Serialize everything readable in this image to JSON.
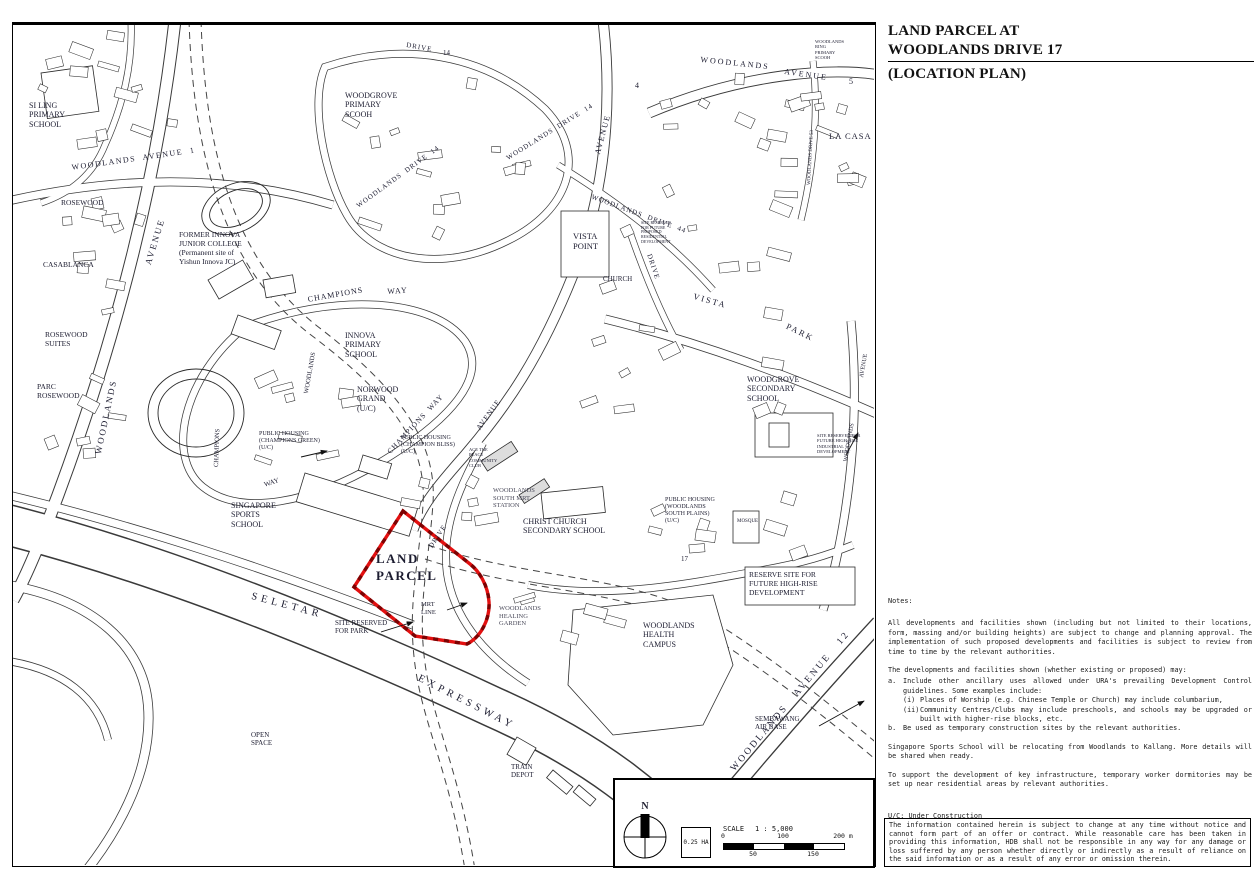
{
  "title": {
    "line1": "LAND PARCEL AT",
    "line2": "WOODLANDS DRIVE 17",
    "line3": "(LOCATION PLAN)"
  },
  "notes": {
    "heading": "Notes:",
    "para1": "All developments and facilities shown (including but not limited to their locations, form, massing and/or building heights) are subject to change and planning approval. The implementation of such proposed developments and facilities is subject to review from time to time by the relevant authorities.",
    "para2_intro": "The developments and facilities shown (whether existing or proposed) may:",
    "item_a_marker": "a.",
    "item_a": "Include other ancillary uses allowed under URA's prevailing Development Control guidelines. Some examples include:",
    "item_ai_marker": "(i)",
    "item_ai": "Places of Worship (e.g. Chinese Temple or Church) may include columbarium,",
    "item_aii_marker": "(ii)",
    "item_aii": "Community Centres/Clubs may include preschools, and schools may be upgraded or built with higher-rise blocks, etc.",
    "item_b_marker": "b.",
    "item_b": "Be used as temporary construction sites by the relevant authorities.",
    "para3": "Singapore Sports School will be relocating from Woodlands to Kallang. More details will be shared when ready.",
    "para4": "To support the development of key infrastructure,  temporary worker dormitories may be set up near residential areas by relevant authorities.",
    "uc": "U/C: Under Construction"
  },
  "disclaimer": "The information contained herein is subject to change at any time without notice and cannot form part of an offer or contract. While reasonable care has been taken in providing this information, HDB shall not be responsible in any way for any damage or loss suffered by any person whether directly or indirectly as a result of reliance on the said information or as a result of any error or omission therein.",
  "map": {
    "parcel_color": "#e31010",
    "parcel_dash_color": "#7d0202",
    "scale": {
      "north": "N",
      "area": "0.25 HA",
      "scale_label": "SCALE",
      "ratio": "1 : 5,000",
      "ticks_top": [
        "0",
        "100",
        "200 m"
      ],
      "ticks_bottom": [
        "50",
        "150"
      ]
    },
    "labels": [
      {
        "text": "SI LING\nPRIMARY\nSCHOOL",
        "x": 16,
        "y": 76,
        "size": 8
      },
      {
        "text": "WOODLANDS  AVENUE  1",
        "x": 58,
        "y": 138,
        "rot": -8,
        "size": 8,
        "ls": 1.5
      },
      {
        "text": "ROSEWOOD",
        "x": 48,
        "y": 174,
        "size": 7.5
      },
      {
        "text": "CASABLANCA",
        "x": 30,
        "y": 236,
        "size": 7.5
      },
      {
        "text": "ROSEWOOD\nSUITES",
        "x": 32,
        "y": 306,
        "size": 7.5
      },
      {
        "text": "PARC\nROSEWOOD",
        "x": 24,
        "y": 358,
        "size": 7.5
      },
      {
        "text": "WOODLANDS",
        "x": 80,
        "y": 428,
        "rot": -78,
        "size": 9,
        "ls": 2
      },
      {
        "text": "AVENUE",
        "x": 130,
        "y": 238,
        "rot": -73,
        "size": 9,
        "ls": 2
      },
      {
        "text": "FORMER INNOVA\nJUNIOR COLLEGE\n(Permanent site of\nYishun Innova JC)",
        "x": 166,
        "y": 206,
        "size": 7.5
      },
      {
        "text": "WOODGROVE\nPRIMARY\nSCOOH",
        "x": 332,
        "y": 66,
        "size": 8
      },
      {
        "text": "DRIVE",
        "x": 394,
        "y": 16,
        "rot": 10,
        "size": 7,
        "ls": 1
      },
      {
        "text": "14",
        "x": 430,
        "y": 24,
        "size": 7
      },
      {
        "text": "WOODLANDS  DRIVE  14",
        "x": 342,
        "y": 178,
        "rot": -36,
        "size": 7,
        "ls": 1
      },
      {
        "text": "WOODLANDS  DRIVE  14",
        "x": 492,
        "y": 130,
        "rot": -32,
        "size": 7,
        "ls": 1
      },
      {
        "text": "WOODLANDS",
        "x": 688,
        "y": 30,
        "rot": 6,
        "size": 8,
        "ls": 2
      },
      {
        "text": "AVENUE",
        "x": 772,
        "y": 42,
        "rot": 8,
        "size": 8,
        "ls": 2
      },
      {
        "text": "5",
        "x": 836,
        "y": 52,
        "size": 8
      },
      {
        "text": "WOODLANDS\nRING\nPRIMARY\nSCOOH",
        "x": 802,
        "y": 14,
        "size": 4.5
      },
      {
        "text": "WOODLANDS DRIVE 53",
        "x": 794,
        "y": 160,
        "rot": -87,
        "size": 5
      },
      {
        "text": "LA CASA",
        "x": 816,
        "y": 106,
        "size": 8.5,
        "ls": 1
      },
      {
        "text": "AVENUE",
        "x": 580,
        "y": 128,
        "rot": -75,
        "size": 8,
        "ls": 1.5
      },
      {
        "text": "4",
        "x": 622,
        "y": 56,
        "size": 8
      },
      {
        "text": "WOODLANDS  DRIVE  44",
        "x": 580,
        "y": 168,
        "rot": 20,
        "size": 7,
        "ls": 1
      },
      {
        "text": "VISTA\nPOINT",
        "x": 560,
        "y": 206,
        "size": 8.5
      },
      {
        "text": "SITE RESERVED\nFOR FUTURE\nPROPOSED\nRESIDENTIAL\nDEVELOPMENT",
        "x": 628,
        "y": 196,
        "size": 4
      },
      {
        "text": "CHURCH",
        "x": 590,
        "y": 250,
        "size": 7
      },
      {
        "text": "DRIVE",
        "x": 640,
        "y": 228,
        "rot": 72,
        "size": 7,
        "ls": 1
      },
      {
        "text": "VISTA",
        "x": 682,
        "y": 266,
        "rot": 16,
        "size": 8.5,
        "ls": 2
      },
      {
        "text": "PARK",
        "x": 776,
        "y": 296,
        "rot": 26,
        "size": 8.5,
        "ls": 2
      },
      {
        "text": "WOODGROVE\nSECONDARY\nSCHOOL",
        "x": 734,
        "y": 350,
        "size": 8
      },
      {
        "text": "AVENUE",
        "x": 846,
        "y": 352,
        "rot": -80,
        "size": 6
      },
      {
        "text": "WOODLANDS",
        "x": 830,
        "y": 436,
        "rot": -80,
        "size": 6
      },
      {
        "text": "SITE RESERVED FOR\nFUTURE HIGH-RISE\nINDUSTRIAL\nDEVELOPMENT",
        "x": 804,
        "y": 408,
        "size": 4.5
      },
      {
        "text": "CHAMPIONS",
        "x": 294,
        "y": 270,
        "rot": -10,
        "size": 8,
        "ls": 1
      },
      {
        "text": "WAY",
        "x": 374,
        "y": 262,
        "rot": -4,
        "size": 8,
        "ls": 1
      },
      {
        "text": "INNOVA\nPRIMARY\nSCHOOL",
        "x": 332,
        "y": 306,
        "size": 8
      },
      {
        "text": "NORWOOD\nGRAND\n(U/C)",
        "x": 344,
        "y": 360,
        "size": 8
      },
      {
        "text": "WOODLANDS",
        "x": 290,
        "y": 368,
        "rot": -80,
        "size": 6.5
      },
      {
        "text": "CHAMPIONS  WAY",
        "x": 373,
        "y": 425,
        "rot": -47,
        "size": 7.5,
        "ls": 1
      },
      {
        "text": "CHAMPIONS",
        "x": 200,
        "y": 442,
        "rot": -88,
        "size": 6.5
      },
      {
        "text": "WAY",
        "x": 250,
        "y": 456,
        "rot": -18,
        "size": 7
      },
      {
        "text": "PUBLIC HOUSING\n(CHAMPIONS GREEN)\n(U/C)",
        "x": 246,
        "y": 406,
        "size": 6
      },
      {
        "text": "PUBLIC HOUSING\n(CHAMPION BLISS)\n(U/C)",
        "x": 388,
        "y": 410,
        "size": 6
      },
      {
        "text": "ACE THE\nPLACE\nCOMMUNITY\nCLUB",
        "x": 456,
        "y": 422,
        "size": 4.5
      },
      {
        "text": "AVENUE",
        "x": 462,
        "y": 402,
        "rot": -54,
        "size": 7.5,
        "ls": 1
      },
      {
        "text": "WOODLANDS\nSOUTH MRT\nSTATION",
        "x": 480,
        "y": 462,
        "size": 6.5,
        "color": "#4a4a5a"
      },
      {
        "text": "CHRIST CHURCH\nSECONDARY SCHOOL",
        "x": 510,
        "y": 492,
        "size": 8
      },
      {
        "text": "PUBLIC HOUSING\n(WOODLANDS\nSOUTH PLAINS)\n(U/C)",
        "x": 652,
        "y": 472,
        "size": 6
      },
      {
        "text": "MOSQUE",
        "x": 724,
        "y": 494,
        "size": 5
      },
      {
        "text": "LAND\nPARCEL",
        "x": 363,
        "y": 526,
        "size": 13,
        "bold": true,
        "ls": 1.5,
        "lh": 1.3
      },
      {
        "text": "MRT\nLINE",
        "x": 408,
        "y": 576,
        "size": 6.5
      },
      {
        "text": "SITE RESERVED\nFOR PARK",
        "x": 322,
        "y": 594,
        "size": 7
      },
      {
        "text": "WOODLANDS\nHEALING\nGARDEN",
        "x": 486,
        "y": 580,
        "size": 6.5,
        "color": "#4a4a5a"
      },
      {
        "text": "WOODLANDS\nHEALTH\nCAMPUS",
        "x": 630,
        "y": 596,
        "size": 8
      },
      {
        "text": "RESERVE SITE FOR\nFUTURE HIGH-RISE\nDEVELOPMENT",
        "x": 736,
        "y": 546,
        "size": 7.5
      },
      {
        "text": "SELETAR",
        "x": 240,
        "y": 566,
        "rot": 15,
        "size": 10.5,
        "ls": 4
      },
      {
        "text": "EXPRESSWAY",
        "x": 408,
        "y": 648,
        "rot": 27,
        "size": 10.5,
        "ls": 4
      },
      {
        "text": "SINGAPORE\nSPORTS\nSCHOOL",
        "x": 218,
        "y": 476,
        "size": 8
      },
      {
        "text": "OPEN\nSPACE",
        "x": 238,
        "y": 706,
        "size": 7
      },
      {
        "text": "TRAIN\nDEPOT",
        "x": 498,
        "y": 738,
        "size": 7
      },
      {
        "text": "WOODLANDS   AVENUE   12",
        "x": 716,
        "y": 742,
        "rot": -50,
        "size": 9.5,
        "ls": 2.5
      },
      {
        "text": "SEMBAWANG\nAIR BASE",
        "x": 742,
        "y": 690,
        "size": 7
      },
      {
        "text": "17",
        "x": 668,
        "y": 530,
        "size": 7
      },
      {
        "text": "DRIVE",
        "x": 414,
        "y": 520,
        "rot": -56,
        "size": 7,
        "ls": 1
      }
    ]
  }
}
